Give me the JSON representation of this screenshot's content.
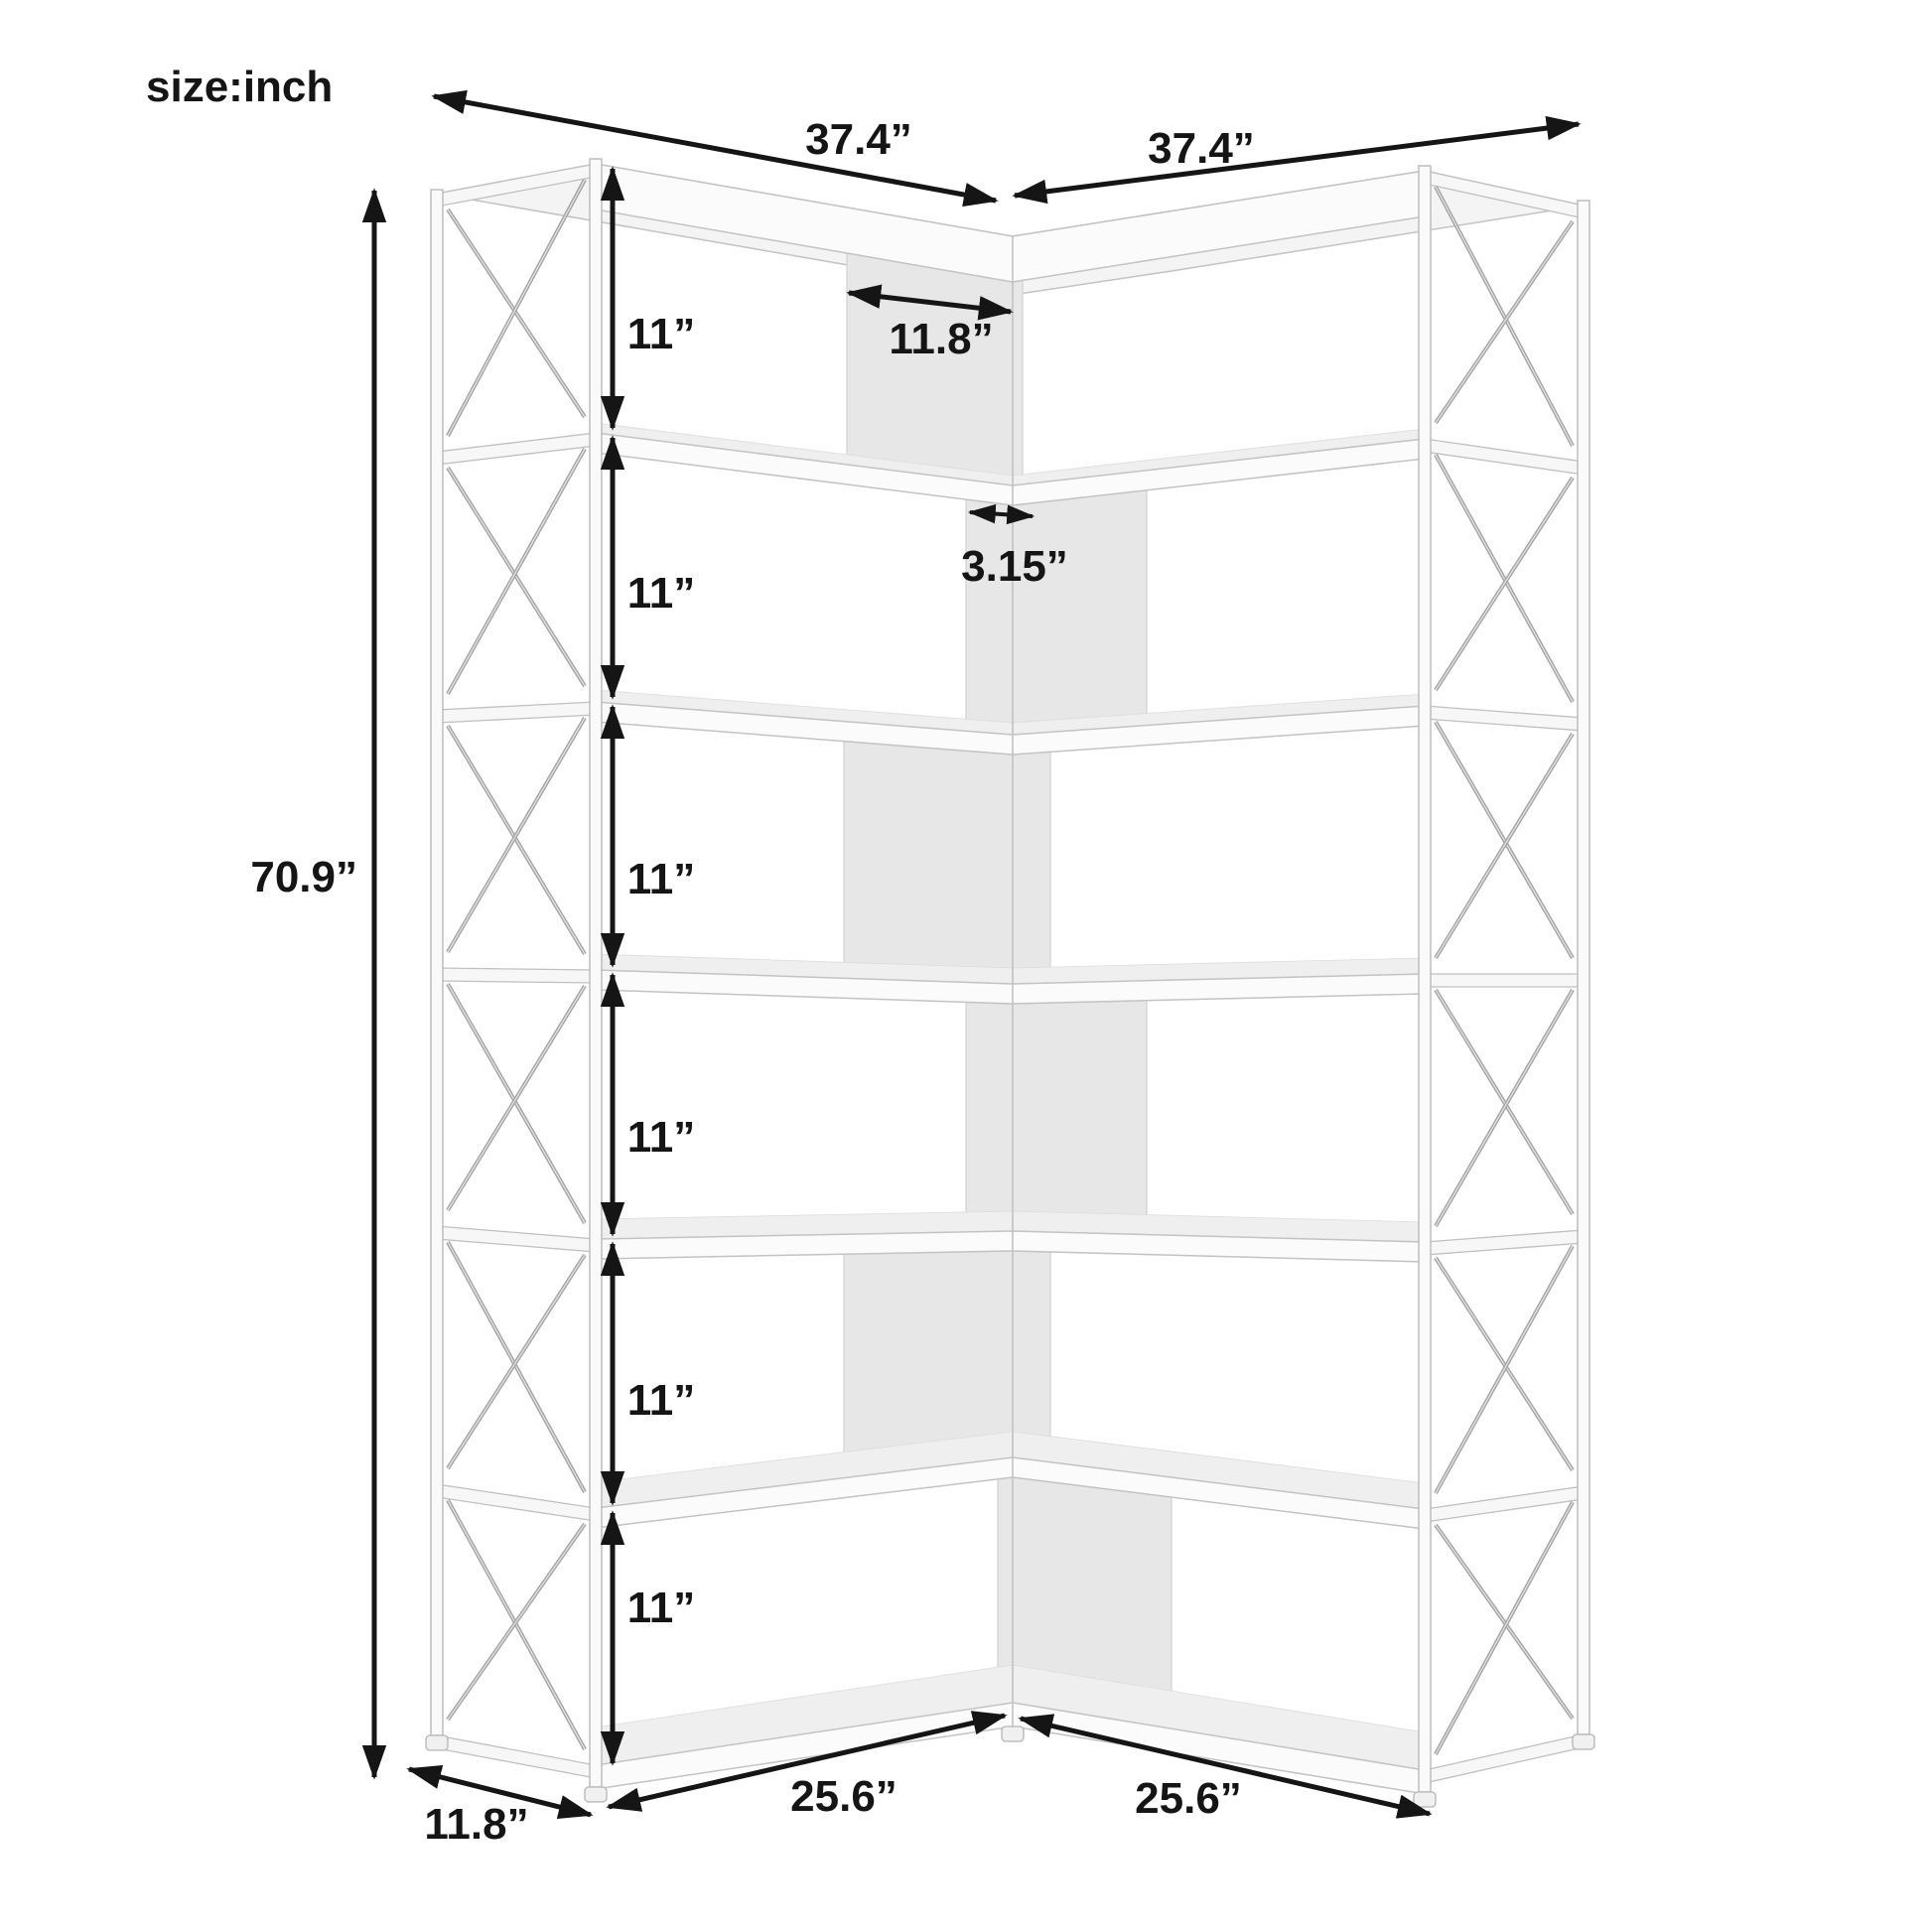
{
  "page": {
    "background": "#ffffff",
    "ink_color": "#151515",
    "frame_line_color": "#c3c3c3",
    "panel_fill_color": "#e7e7e7"
  },
  "labels": {
    "units": "size:inch",
    "top_width_left": "37.4”",
    "top_width_right": "37.4”",
    "total_height": "70.9”",
    "shelf_spacing": "11”",
    "corner_shelf_width": "11.8”",
    "corner_offset": "3.15”",
    "side_depth": "11.8”",
    "bottom_width_left": "25.6”",
    "bottom_width_right": "25.6”"
  },
  "figure": {
    "type": "product-dimension-diagram",
    "subject": "7-tier L-shaped corner bookshelf with metal X cross-brace side frames, shown in perspective with black dimension arrows",
    "shelf_tiers": 7,
    "open_compartments_per_wing": 6
  }
}
